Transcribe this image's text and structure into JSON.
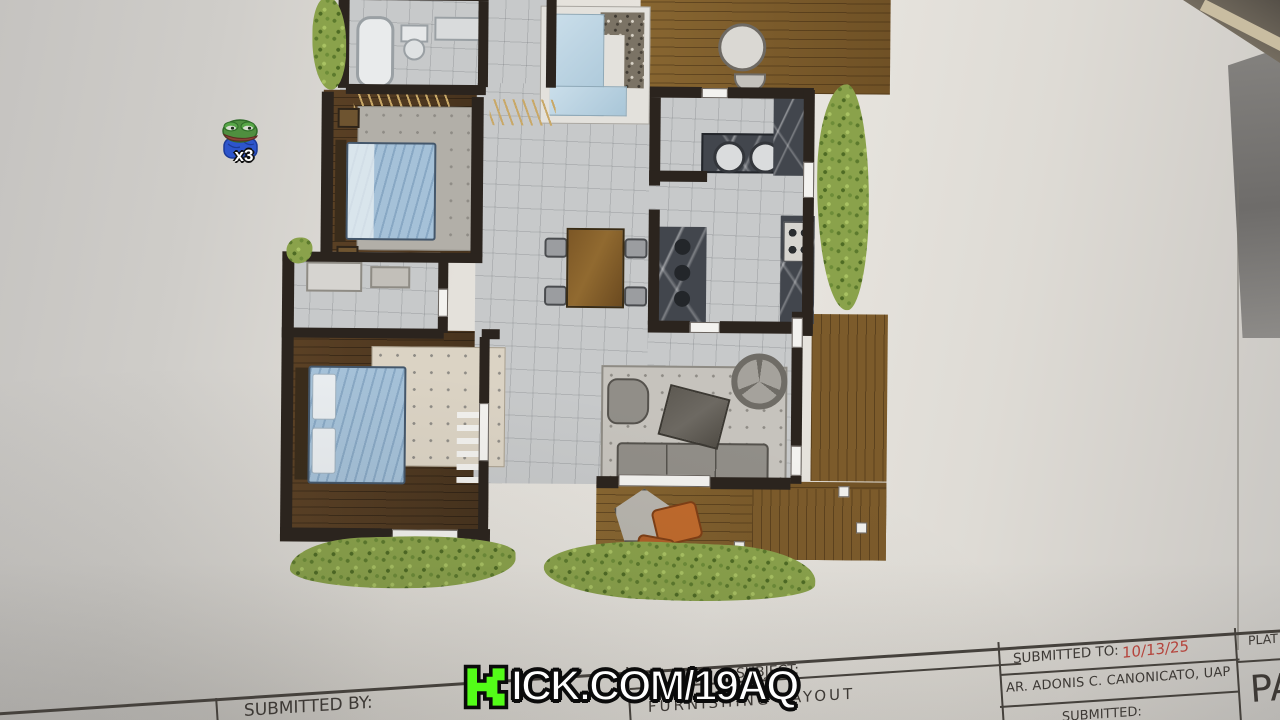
{
  "overlay": {
    "watermark": {
      "logo_icon": "kick-logo",
      "text": "ICK.COM/19AQ",
      "green": "#53fc18"
    },
    "emote": {
      "icon": "pepe-emote",
      "count": "x3"
    }
  },
  "title_block": {
    "submitted_by_label": "SUBMITTED BY:",
    "subject_label": "SUBJECT:",
    "subject_value": "FURNISHING LAYOUT",
    "submitted_to_label": "SUBMITTED TO:",
    "submitted_to_date": "10/13/25",
    "architect": "AR. ADONIS C. CANONICATO, UAP",
    "partial_bottom_label": "SUBMITTED:",
    "plate_label": "PLAT",
    "plate_value": "PA",
    "date_color": "#b5443c"
  },
  "drawing": {
    "colors": {
      "walls": "#2b241e",
      "bedroom_wood": "#4e3922",
      "deck_wood": "#7c5b2b",
      "floor_tile": "#c7c9ca",
      "water_feature": "#bad3e1",
      "plants": "#8aa24b",
      "bed_linen_blue": "#a5c1d8",
      "counter_marble": "#42464d",
      "accent_orange": "#c06a2c"
    }
  }
}
